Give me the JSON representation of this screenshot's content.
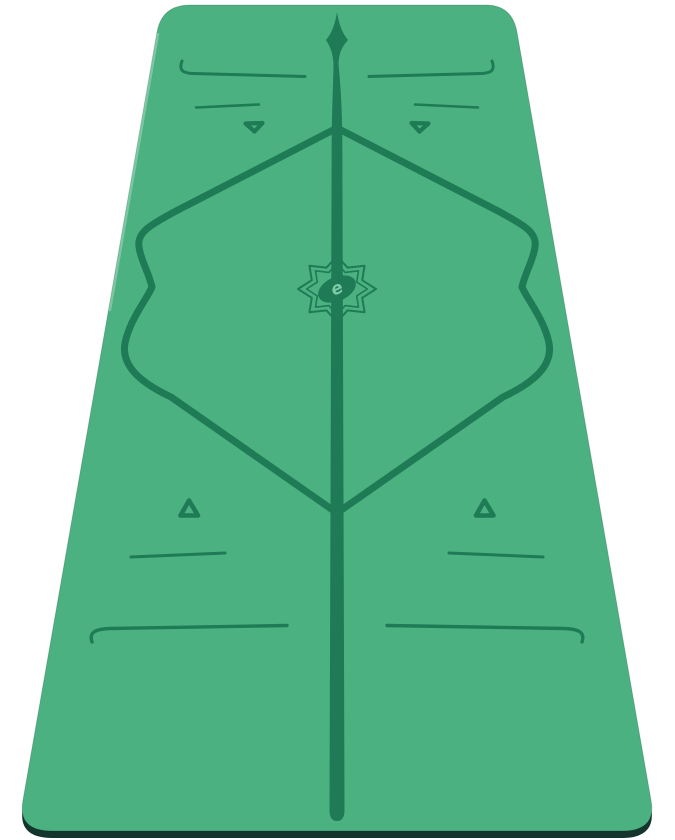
{
  "product": {
    "name": "green yoga mat with etched alignment guide lines",
    "logo_glyph": "e"
  },
  "colors": {
    "background": "#ffffff",
    "mat": "#4bb181",
    "marking": "#1e7b55",
    "edge": "#14352b",
    "edge_highlight": "#6ec49c",
    "logo_glyph": "#7ccaa4"
  }
}
